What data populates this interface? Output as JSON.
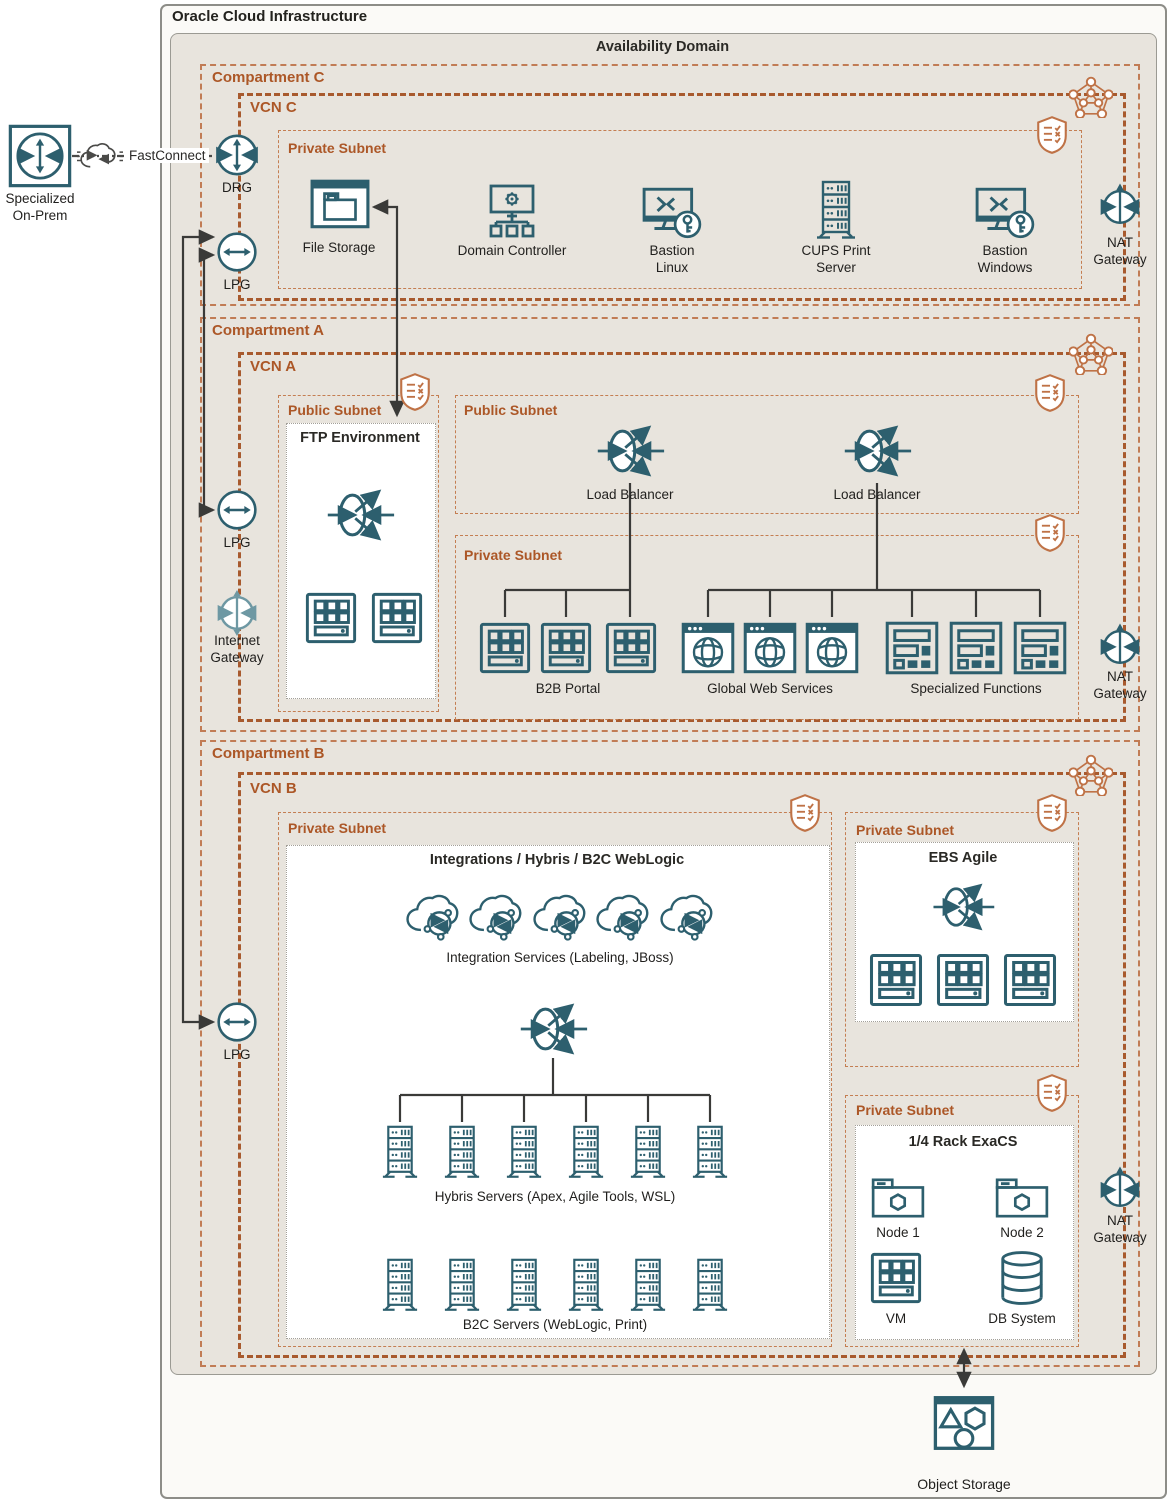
{
  "header": {
    "title": "Oracle Cloud Infrastructure",
    "availability_domain": "Availability Domain"
  },
  "external": {
    "on_prem_label": "Specialized On-Prem",
    "fastconnect_label": "FastConnect",
    "object_storage_label": "Object Storage"
  },
  "left_rail": {
    "drg": "DRG",
    "lpg_top": "LPG",
    "lpg_mid": "LPG",
    "lpg_bottom": "LPG",
    "internet_gateway": "Internet Gateway"
  },
  "compartment_c": {
    "label": "Compartment C",
    "vcn": "VCN C",
    "subnet": "Private Subnet",
    "nodes": [
      {
        "label": "File Storage",
        "icon": "file-storage-icon"
      },
      {
        "label": "Domain Controller",
        "icon": "domain-controller-icon"
      },
      {
        "label": "Bastion Linux",
        "icon": "bastion-icon"
      },
      {
        "label": "CUPS Print Server",
        "icon": "server-rack-icon"
      },
      {
        "label": "Bastion Windows",
        "icon": "bastion-icon"
      }
    ],
    "nat": "NAT Gateway"
  },
  "compartment_a": {
    "label": "Compartment A",
    "vcn": "VCN A",
    "ftp_subnet": {
      "label": "Public Subnet",
      "box_title": "FTP Environment"
    },
    "lb_subnet": {
      "label": "Public Subnet",
      "lb1": "Load Balancer",
      "lb2": "Load Balancer"
    },
    "private_subnet": {
      "label": "Private Subnet",
      "groups": [
        {
          "label": "B2B Portal",
          "icon": "instance-icon",
          "count": 3
        },
        {
          "label": "Global Web Services",
          "icon": "browser-globe-icon",
          "count": 3
        },
        {
          "label": "Specialized Functions",
          "icon": "specialized-function-icon",
          "count": 3
        }
      ]
    },
    "nat": "NAT Gateway"
  },
  "compartment_b": {
    "label": "Compartment B",
    "vcn": "VCN B",
    "integrations_subnet": {
      "label": "Private Subnet",
      "box_title": "Integrations / Hybris / B2C WebLogic",
      "integration_caption": "Integration Services (Labeling, JBoss)",
      "hybris_caption": "Hybris Servers (Apex, Agile Tools, WSL)",
      "b2c_caption": "B2C Servers (WebLogic, Print)"
    },
    "ebs_subnet": {
      "label": "Private Subnet",
      "box_title": "EBS Agile"
    },
    "exacs_subnet": {
      "label": "Private Subnet",
      "box_title": "1/4 Rack ExaCS",
      "nodes": [
        {
          "label": "Node 1",
          "icon": "node-folder-icon"
        },
        {
          "label": "Node 2",
          "icon": "node-folder-icon"
        },
        {
          "label": "VM",
          "icon": "instance-icon"
        },
        {
          "label": "DB System",
          "icon": "database-icon"
        }
      ]
    },
    "nat": "NAT Gateway"
  },
  "colors": {
    "icon_teal": "#2D5F6E",
    "icon_teal_light": "#6E98A3",
    "accent_orange": "#AC5727",
    "dash_vcn": "#A85A2E",
    "dash_compartment": "#C17C55",
    "connector_black": "#3A3A38"
  }
}
